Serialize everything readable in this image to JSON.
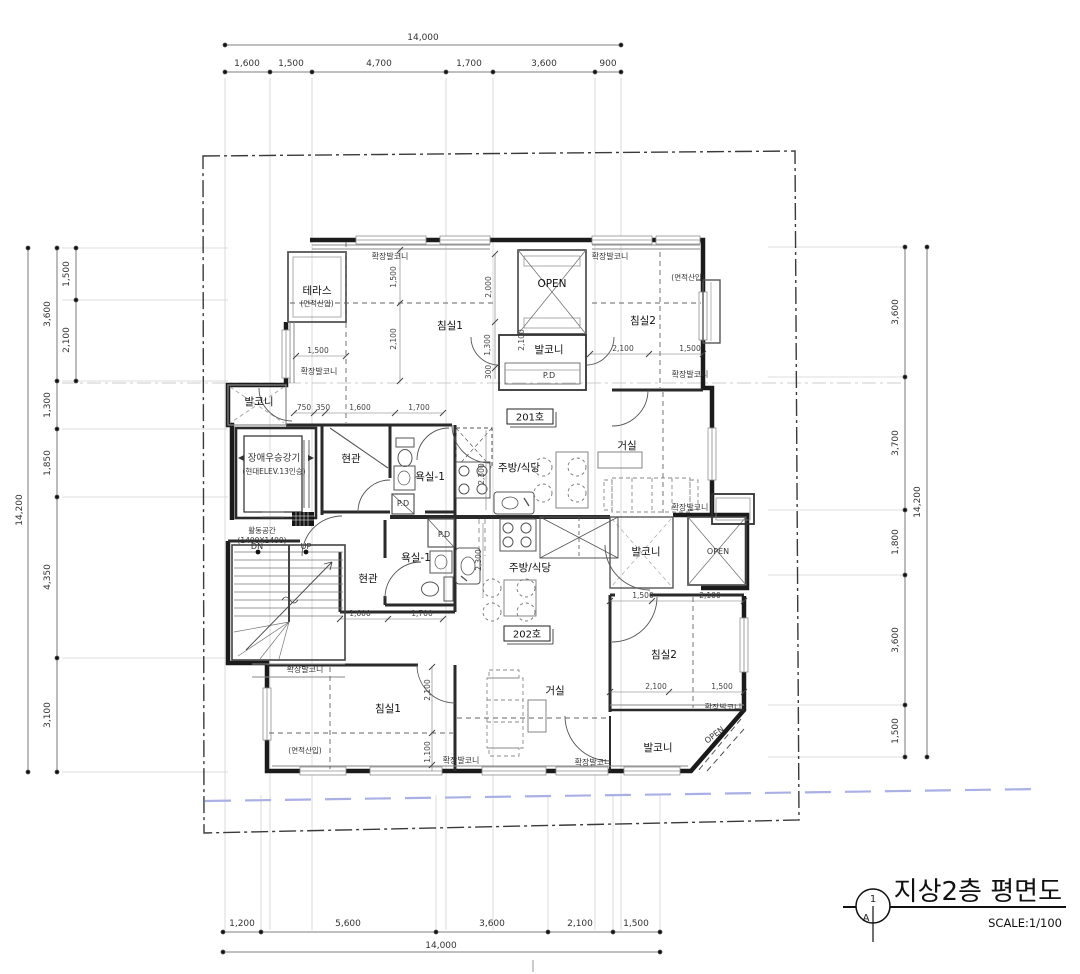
{
  "title_block": {
    "detail_number": "1",
    "sheet_letter": "A",
    "title": "지상2층 평면도",
    "scale": "SCALE:1/100"
  },
  "dimensions": {
    "top": {
      "total": "14,000",
      "segments": [
        "1,600",
        "1,500",
        "4,700",
        "1,700",
        "3,600",
        "900"
      ]
    },
    "bottom": {
      "total": "14,000",
      "segments": [
        "1,200",
        "5,600",
        "3,600",
        "2,100",
        "1,500"
      ]
    },
    "left": {
      "total": "14,200",
      "segments": [
        "3,600",
        "1,300",
        "1,850",
        "4,350",
        "3,100"
      ],
      "inner": [
        "1,500",
        "2,100"
      ]
    },
    "right": {
      "total": "14,200",
      "segments": [
        "3,600",
        "3,700",
        "1,800",
        "3,600",
        "1,500"
      ]
    }
  },
  "plan_dims": [
    "1,500",
    "2,100",
    "2,000",
    "1,300",
    "300",
    "1,500",
    "750",
    "350",
    "1,600",
    "1,700",
    "2,100",
    "1,500",
    "2,100",
    "2,300",
    "1,500",
    "2,100",
    "1,600",
    "1,700",
    "2,300",
    "2,100",
    "1,500",
    "2,100",
    "1,100"
  ],
  "labels": {
    "u201": {
      "tag": "201호",
      "terrace": "테라스",
      "terrace_note": "(면적산입)",
      "ext_balcony_top_left": "확장발코니",
      "ext_balcony_left": "확장발코니",
      "bedroom1": "침실1",
      "ext_balcony_top_right": "확장발코니",
      "area_note": "(면적산입)",
      "open_shaft": "OPEN",
      "bedroom2": "침실2",
      "balcony_top": "발코니",
      "pd_top": "P.D",
      "ext_balcony_right": "확장발코니",
      "entry": "현관",
      "bath": "욕실-1",
      "pd_mid": "P.D",
      "kitchen": "주방/식당",
      "living": "거실",
      "ext_balcony_living": "확장발코니",
      "balcony_right": "발코니",
      "open_right": "OPEN"
    },
    "common": {
      "elevator": "장애우승강기",
      "elevator_note": "(현대ELEV.13인승)",
      "balcony_left": "발코니",
      "activity": "활동공간",
      "activity_note": "(1400X1400)",
      "down": "DN",
      "up": "UP",
      "ext_balcony_stair": "확장발코니"
    },
    "u202": {
      "tag": "202호",
      "entry": "현관",
      "bath": "욕실-1",
      "pd": "P.D",
      "kitchen": "주방/식당",
      "living": "거실",
      "ext_balcony_living": "확장발코니",
      "bedroom1": "침실1",
      "area_note": "(면적산입)",
      "ext_balcony_bed1": "확장발코니",
      "bedroom2": "침실2",
      "ext_balcony_bed2": "확장발코니",
      "balcony": "발코니",
      "open_corner": "OPEN"
    }
  }
}
